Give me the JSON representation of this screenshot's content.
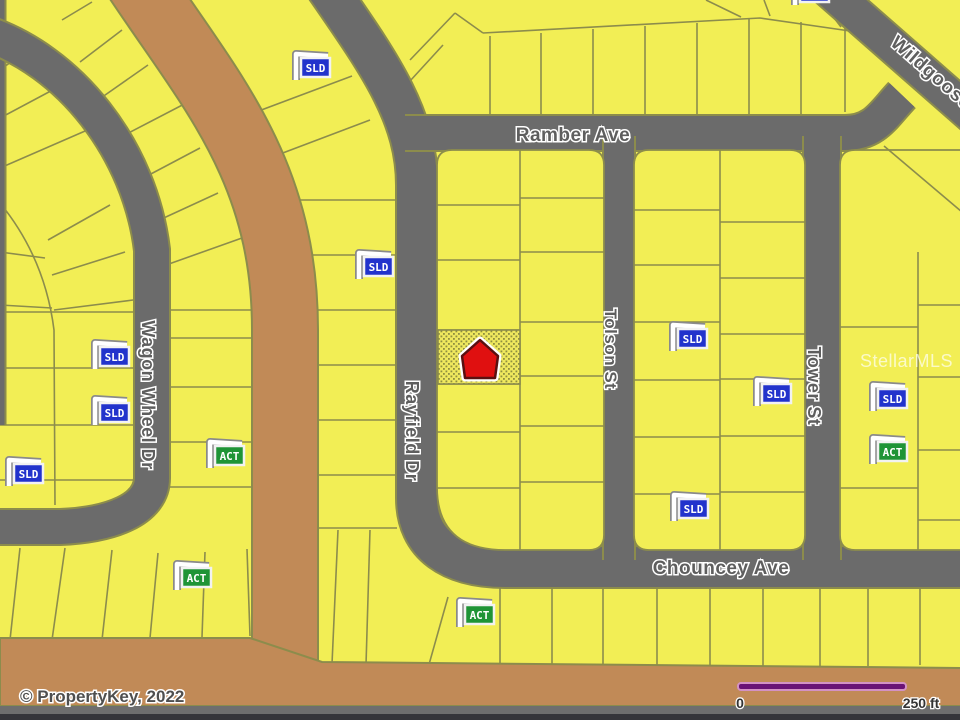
{
  "streets": {
    "ramber": "Ramber Ave",
    "wildgoose": "Wildgoose",
    "wagon_wheel": "Wagon Wheel Dr",
    "rayfield": "Rayfield Dr",
    "tolson": "Tolson St",
    "tower": "Tower St",
    "chouncey": "Chouncey Ave"
  },
  "markers": {
    "sold_label": "SLD",
    "active_label": "ACT",
    "subject": {
      "type": "red-house",
      "x": 480,
      "y": 359
    },
    "items": [
      {
        "type": "sold",
        "x": 293,
        "y": 49
      },
      {
        "type": "sold",
        "x": 356,
        "y": 248
      },
      {
        "type": "sold",
        "x": 92,
        "y": 338
      },
      {
        "type": "sold",
        "x": 92,
        "y": 394
      },
      {
        "type": "sold",
        "x": 6,
        "y": 455
      },
      {
        "type": "sold",
        "x": 670,
        "y": 320
      },
      {
        "type": "sold",
        "x": 754,
        "y": 375
      },
      {
        "type": "sold",
        "x": 870,
        "y": 380
      },
      {
        "type": "sold",
        "x": 671,
        "y": 490
      },
      {
        "type": "sold",
        "x": 792,
        "y": -26
      },
      {
        "type": "active",
        "x": 207,
        "y": 437
      },
      {
        "type": "active",
        "x": 174,
        "y": 559
      },
      {
        "type": "active",
        "x": 870,
        "y": 433
      },
      {
        "type": "active",
        "x": 457,
        "y": 596
      }
    ]
  },
  "watermark": "StellarMLS",
  "copyright": "© PropertyKey, 2022",
  "scale_bar": {
    "start_label": "0",
    "end_label": "250 ft"
  },
  "colors": {
    "parcel_yellow": "#f2ee55",
    "lot_line_olive": "#8c8c4c",
    "road_gray": "#6b6b6b",
    "dirt_road_brown": "#c18a57",
    "sold_flag_blue": "#2233cc",
    "active_flag_green": "#1f9436",
    "subject_red": "#e01010",
    "scale_bar_purple": "#6a1276",
    "scale_bar_pink": "#d391c4"
  }
}
